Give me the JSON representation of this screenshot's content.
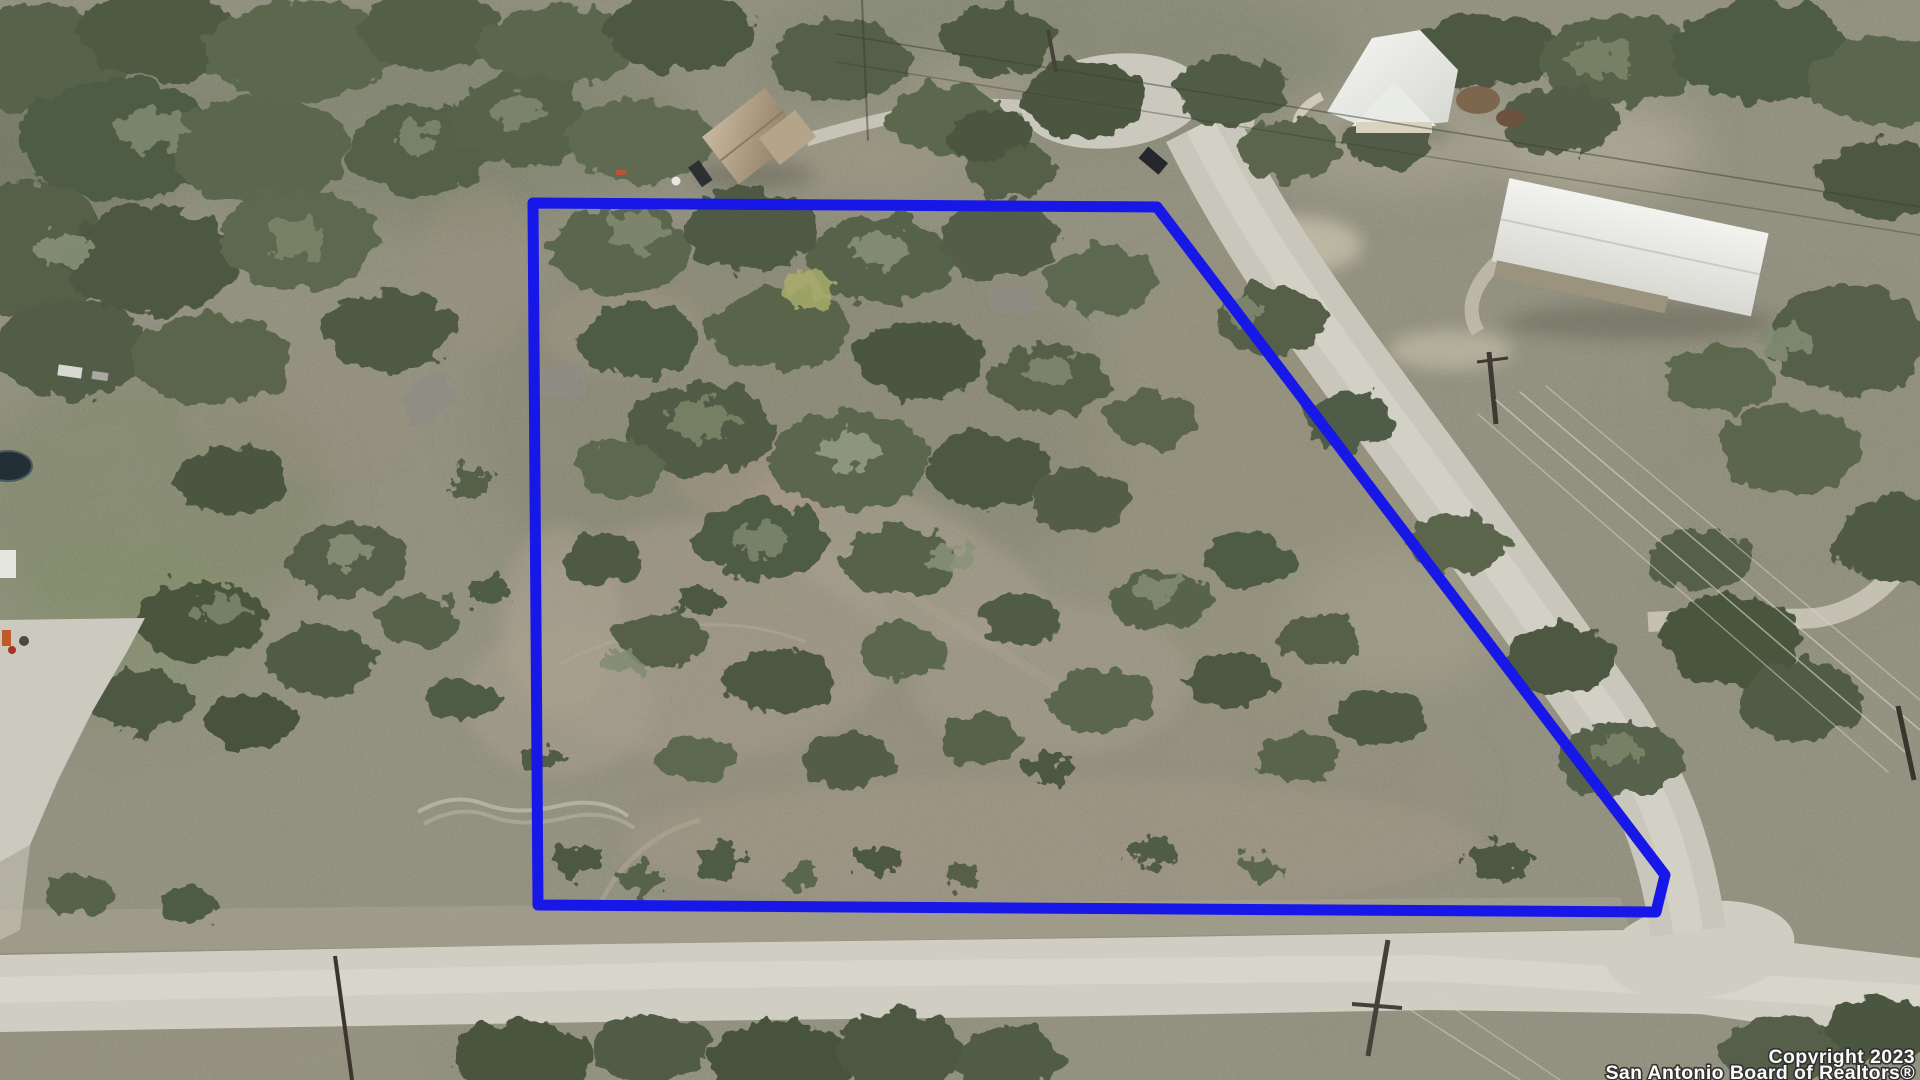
{
  "image": {
    "type": "aerial-drone-photograph",
    "subject": "Wooded hill-country land parcel for sale with surveyed lot lines overlaid",
    "width_px": 1920,
    "height_px": 1080
  },
  "boundary": {
    "label": "property-lot-line-overlay",
    "color": "#1717e8",
    "stroke_width": 11,
    "points": "533,203 1157,207 1665,875 1656,912 538,905"
  },
  "watermark": {
    "line1": "Copyright 2023",
    "line2": "San Antonio Board of Realtors®",
    "text_color": "#ffffff",
    "outline_color": "#2f2f2f"
  },
  "scene": {
    "terrain_base_color": "#8d8b7a",
    "road_color": "#cbc8bd",
    "road_highlight_color": "#d7d4c9",
    "tree_dark_color": "#49553d",
    "tree_mid_color": "#57624a",
    "tree_light_color": "#828b72",
    "dirt_color": "#a19786",
    "pasture_color": "#76825c",
    "features": [
      "cul-de-sac with island tree at top",
      "gravel road running diagonally along east lot line",
      "gravel road across bottom of frame",
      "tan house with gray roof top-center",
      "white steep-roof house top-right",
      "large white metal building on right",
      "concrete pad and equipment lower-left",
      "round stock tank on left edge",
      "utility poles and overhead power lines",
      "dark SUV on road near cul-de-sac",
      "scrub oak and juniper tree cover with caliche clearings"
    ]
  }
}
